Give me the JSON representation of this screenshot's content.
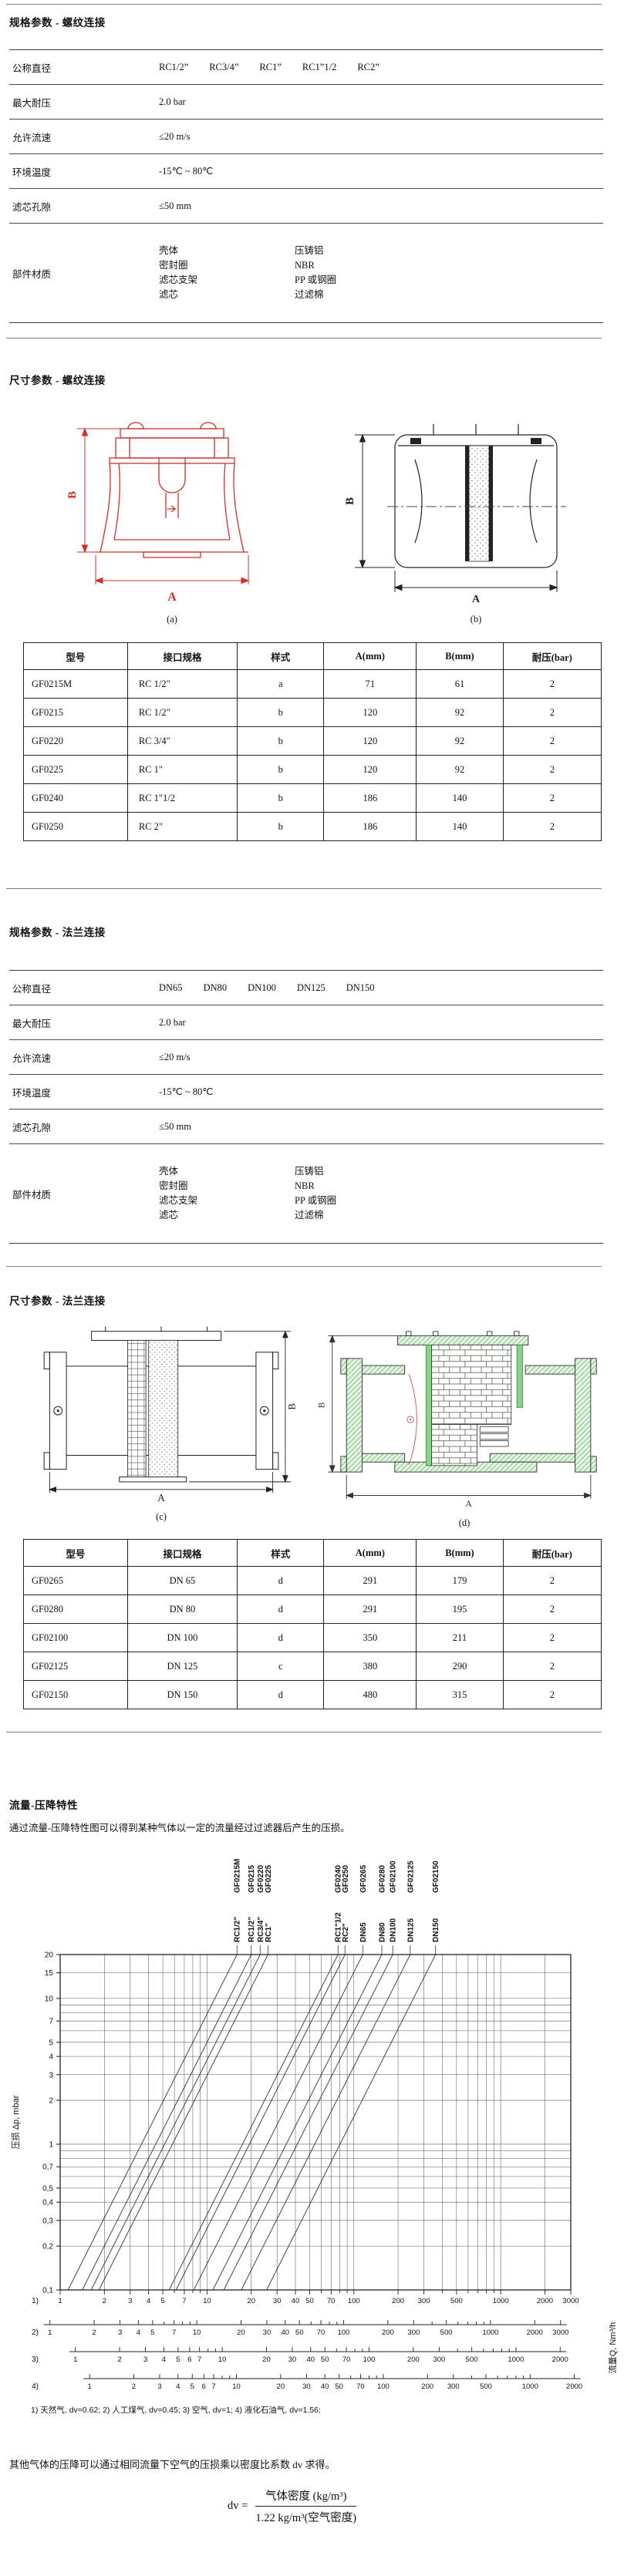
{
  "dims": {
    "a": "A",
    "b": "B"
  },
  "figures": {
    "a": "(a)",
    "b": "(b)",
    "c": "(c)",
    "d": "(d)"
  },
  "thread_spec": {
    "title": "规格参数 - 螺纹连接",
    "rows": [
      {
        "label": "公称直径",
        "values": [
          "RC1/2”",
          "RC3/4”",
          "RC1”",
          "RC1”1/2",
          "RC2”"
        ]
      },
      {
        "label": "最大耐压",
        "values": [
          "2.0 bar"
        ]
      },
      {
        "label": "允许流速",
        "values": [
          "≤20 m/s"
        ]
      },
      {
        "label": "环境温度",
        "values": [
          "-15℃ ~ 80℃"
        ]
      },
      {
        "label": "滤芯孔隙",
        "values": [
          "≤50 mm"
        ]
      },
      {
        "label": "部件材质",
        "materials": [
          [
            "壳体",
            "压铸铝"
          ],
          [
            "密封圈",
            "NBR"
          ],
          [
            "滤芯支架",
            "PP 或钢圈"
          ],
          [
            "滤芯",
            "过滤棉"
          ]
        ]
      }
    ]
  },
  "thread_dim": {
    "title": "尺寸参数 - 螺纹连接"
  },
  "thread_table": {
    "headers": [
      "型号",
      "接口规格",
      "样式",
      "A(mm)",
      "B(mm)",
      "耐压(bar)"
    ],
    "rows": [
      [
        "GF0215M",
        "RC 1/2\"",
        "a",
        "71",
        "61",
        "2"
      ],
      [
        "GF0215",
        "RC 1/2\"",
        "b",
        "120",
        "92",
        "2"
      ],
      [
        "GF0220",
        "RC 3/4\"",
        "b",
        "120",
        "92",
        "2"
      ],
      [
        "GF0225",
        "RC 1\"",
        "b",
        "120",
        "92",
        "2"
      ],
      [
        "GF0240",
        "RC 1\"1/2",
        "b",
        "186",
        "140",
        "2"
      ],
      [
        "GF0250",
        "RC 2\"",
        "b",
        "186",
        "140",
        "2"
      ]
    ]
  },
  "flange_spec": {
    "title": "规格参数 - 法兰连接",
    "rows": [
      {
        "label": "公称直径",
        "values": [
          "DN65",
          "DN80",
          "DN100",
          "DN125",
          "DN150"
        ]
      },
      {
        "label": "最大耐压",
        "values": [
          "2.0 bar"
        ]
      },
      {
        "label": "允许流速",
        "values": [
          "≤20 m/s"
        ]
      },
      {
        "label": "环境温度",
        "values": [
          "-15℃ ~ 80℃"
        ]
      },
      {
        "label": "滤芯孔隙",
        "values": [
          "≤50 mm"
        ]
      },
      {
        "label": "部件材质",
        "materials": [
          [
            "壳体",
            "压铸铝"
          ],
          [
            "密封圈",
            "NBR"
          ],
          [
            "滤芯支架",
            "PP 或钢圈"
          ],
          [
            "滤芯",
            "过滤棉"
          ]
        ]
      }
    ]
  },
  "flange_dim": {
    "title": "尺寸参数 - 法兰连接"
  },
  "flange_table": {
    "headers": [
      "型号",
      "接口规格",
      "样式",
      "A(mm)",
      "B(mm)",
      "耐压(bar)"
    ],
    "rows": [
      [
        "GF0265",
        "DN 65",
        "d",
        "291",
        "179",
        "2"
      ],
      [
        "GF0280",
        "DN 80",
        "d",
        "291",
        "195",
        "2"
      ],
      [
        "GF02100",
        "DN 100",
        "d",
        "350",
        "211",
        "2"
      ],
      [
        "GF02125",
        "DN 125",
        "c",
        "380",
        "290",
        "2"
      ],
      [
        "GF02150",
        "DN 150",
        "d",
        "480",
        "315",
        "2"
      ]
    ]
  },
  "flow_section": {
    "title": "流量-压降特性",
    "description": "通过流量-压降特性图可以得到某种气体以一定的流量经过过滤器后产生的压损。",
    "gas_note": "1) 天然气, dv=0.62;      2) 人工煤气, dv=0.45;      3) 空气, dv=1;      4) 液化石油气, dv=1.56;",
    "footer_note": "其他气体的压降可以通过相同流量下空气的压损乘以密度比系数 dv 求得。",
    "formula": {
      "lhs": "dv =",
      "numerator": "气体密度 (kg/m³)",
      "denominator": "1.22 kg/m³(空气密度)"
    }
  },
  "chart_data": {
    "type": "line",
    "title": "流量-压降特性",
    "xlabel": "流量Q, Nm³/h",
    "ylabel": "压损 Δp, mbar",
    "x_scale": "log",
    "y_scale": "log",
    "xlim": [
      1,
      3000
    ],
    "ylim": [
      0.1,
      20
    ],
    "grid": true,
    "slope_loglog": 2,
    "y_tick_values": [
      20,
      15,
      10,
      7,
      5,
      4,
      3,
      2,
      1,
      0.7,
      0.5,
      0.4,
      0.3,
      0.2,
      0.1
    ],
    "y_tick_labels": [
      "20",
      "15",
      "10",
      "7",
      "5",
      "4",
      "3",
      "2",
      "1",
      "0,7",
      "0,5",
      "0,4",
      "0,3",
      "0,2",
      "0,1"
    ],
    "series": [
      {
        "model": "GF0215M",
        "size": "RC1/2\"",
        "q_at_20mbar": 16
      },
      {
        "model": "GF0215",
        "size": "RC1/2\"",
        "q_at_20mbar": 20
      },
      {
        "model": "GF0220",
        "size": "RC3/4\"",
        "q_at_20mbar": 23
      },
      {
        "model": "GF0225",
        "size": "RC1\"",
        "q_at_20mbar": 26
      },
      {
        "model": "GF0240",
        "size": "RC1\"1/2",
        "q_at_20mbar": 78
      },
      {
        "model": "GF0250",
        "size": "RC2\"",
        "q_at_20mbar": 87
      },
      {
        "model": "GF0265",
        "size": "DN65",
        "q_at_20mbar": 115
      },
      {
        "model": "GF0280",
        "size": "DN80",
        "q_at_20mbar": 155
      },
      {
        "model": "GF02100",
        "size": "DN100",
        "q_at_20mbar": 184
      },
      {
        "model": "GF02125",
        "size": "DN125",
        "q_at_20mbar": 242
      },
      {
        "model": "GF02150",
        "size": "DN150",
        "q_at_20mbar": 360
      }
    ],
    "x_scales": [
      {
        "id": "1)",
        "gas": "天然气",
        "dv": "0.62",
        "max": 3000,
        "tick_labels": [
          1,
          2,
          3,
          4,
          5,
          7,
          10,
          20,
          30,
          40,
          50,
          70,
          100,
          200,
          300,
          500,
          1000,
          2000,
          3000
        ]
      },
      {
        "id": "2)",
        "gas": "人工煤气",
        "dv": "0.45",
        "max": 3000,
        "tick_labels": [
          1,
          2,
          3,
          4,
          5,
          7,
          10,
          20,
          30,
          40,
          50,
          70,
          100,
          200,
          300,
          500,
          1000,
          2000,
          3000
        ]
      },
      {
        "id": "3)",
        "gas": "空气",
        "dv": "1",
        "max": 2000,
        "tick_labels": [
          1,
          2,
          3,
          4,
          5,
          6,
          7,
          10,
          20,
          30,
          40,
          50,
          70,
          100,
          200,
          300,
          500,
          1000,
          2000
        ]
      },
      {
        "id": "4)",
        "gas": "液化石油气",
        "dv": "1.56",
        "max": 2000,
        "tick_labels": [
          1,
          2,
          3,
          4,
          5,
          6,
          7,
          10,
          20,
          30,
          40,
          50,
          70,
          100,
          200,
          300,
          500,
          1000,
          2000
        ]
      }
    ]
  }
}
